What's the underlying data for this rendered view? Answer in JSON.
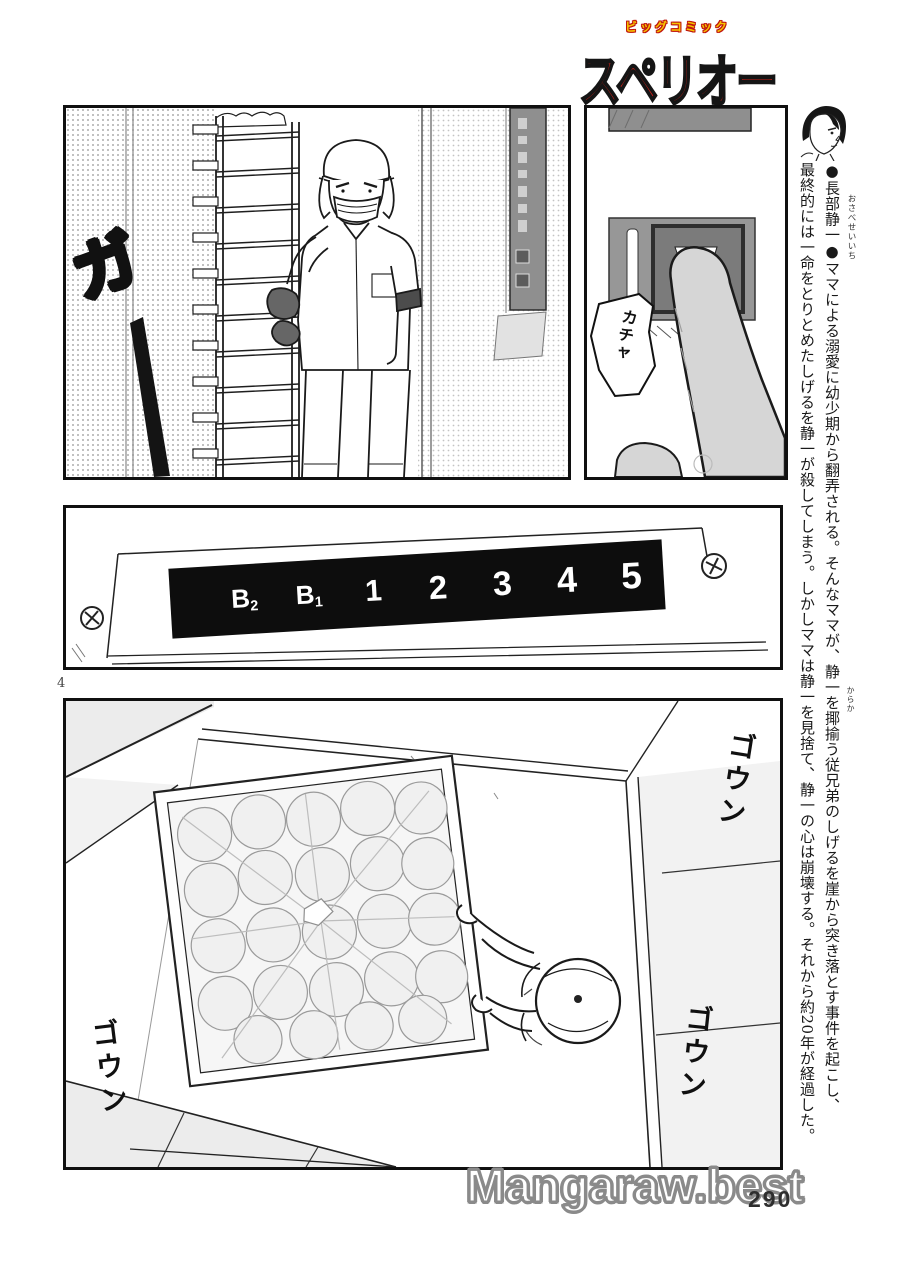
{
  "header": {
    "magazine_small": "ビッグコミック",
    "magazine_main": "スペリオール",
    "small_color": "#f6c400",
    "main_color": "#cf2218"
  },
  "sidebar": {
    "furigana_name": "おさべせいいち",
    "furigana_karakau": "からか",
    "column_1": "●長部静一●ママによる溺愛に幼少期から翻弄される。そんなママが、静一を揶揄う従兄弟のしげるを崖から突き落とす事件を起こし、",
    "column_2": "最終的には一命をとりとめたしげるを静一が殺してしまう。しかしママは静一を見捨て、静一の心は崩壊する。それから約20年が経過した。"
  },
  "panels": {
    "workroom": {
      "sfx_ga": "ガ"
    },
    "button": {
      "sfx_kacha": "カチャ"
    },
    "elevator_indicator": {
      "display_bg": "#0d0d0d",
      "floors": [
        {
          "main": "B",
          "sub": "2"
        },
        {
          "main": "B",
          "sub": "1"
        },
        {
          "main": "1"
        },
        {
          "main": "2"
        },
        {
          "main": "3"
        },
        {
          "main": "4"
        },
        {
          "main": "5"
        }
      ]
    },
    "overhead": {
      "sfx_goun_1": "ゴウン",
      "sfx_goun_2": "ゴウン",
      "sfx_goun_3": "ゴウン"
    }
  },
  "footer": {
    "page_label": "4",
    "watermark": "Mangaraw.best",
    "printed_page": "290"
  }
}
